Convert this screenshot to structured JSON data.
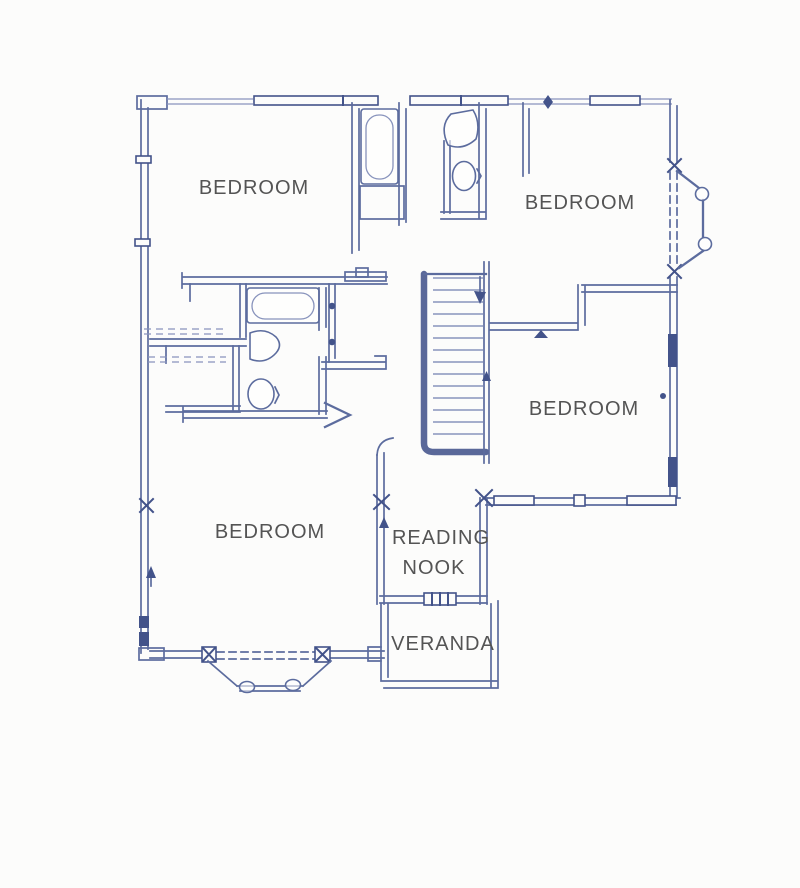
{
  "floor_plan": {
    "labels": {
      "bedroom_top_left": "BEDROOM",
      "bedroom_top_right": "BEDROOM",
      "bedroom_mid_right": "BEDROOM",
      "bedroom_bottom_left": "BEDROOM",
      "reading_nook_line1": "READING",
      "reading_nook_line2": "NOOK",
      "veranda": "VERANDA"
    },
    "fixtures": {
      "bathtubs": 2,
      "toilets": 2,
      "sinks": 2,
      "staircases": 1,
      "bay_windows": 2,
      "closets_with_rails": 2
    },
    "colors": {
      "wall_ink": "#5c6c9e",
      "wall_ink_dark": "#43538a",
      "wall_ink_light": "#8893bc",
      "label_text": "#545454",
      "background": "#fcfcfb"
    }
  }
}
